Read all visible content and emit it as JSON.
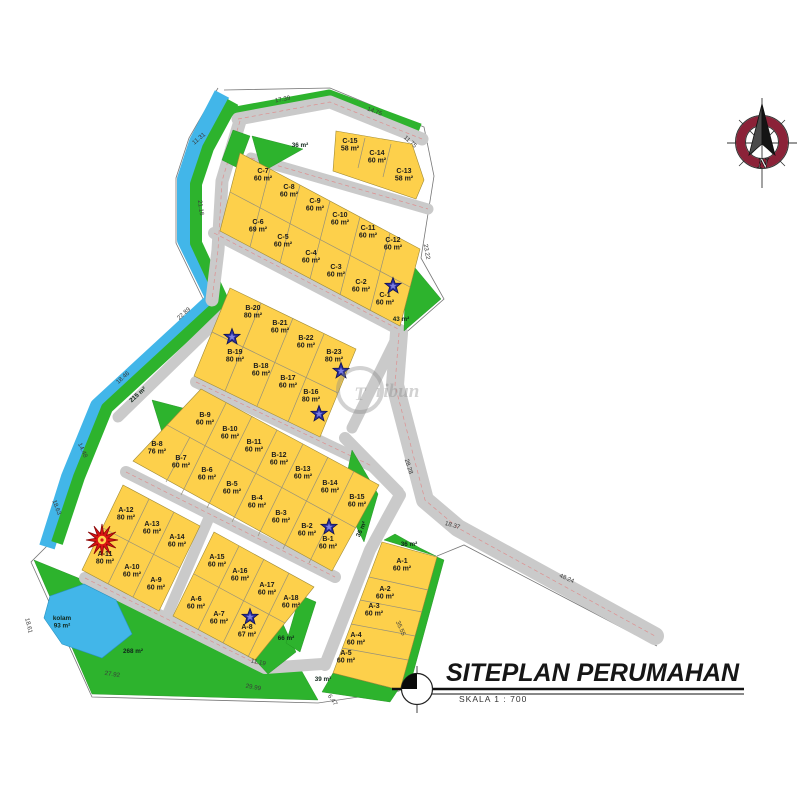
{
  "title": {
    "main": "SITEPLAN PERUMAHAN",
    "scale": "SKALA 1 : 700"
  },
  "compass": {
    "north_label": "N"
  },
  "watermark": {
    "initial": "T",
    "rest": "ribun"
  },
  "colors": {
    "lot": "#fdd04b",
    "green": "#2db32d",
    "water": "#42b6e9",
    "road": "#cacaca",
    "compass_ring": "#8b2238"
  },
  "lots": [
    {
      "id": "C-15",
      "area": "58 m²",
      "x": 350,
      "y": 143
    },
    {
      "id": "C-14",
      "area": "60 m²",
      "x": 377,
      "y": 155
    },
    {
      "id": "C-13",
      "area": "58 m²",
      "x": 404,
      "y": 173
    },
    {
      "id": "C-7",
      "area": "60 m²",
      "x": 263,
      "y": 173
    },
    {
      "id": "C-8",
      "area": "60 m²",
      "x": 289,
      "y": 189
    },
    {
      "id": "C-9",
      "area": "60 m²",
      "x": 315,
      "y": 203
    },
    {
      "id": "C-10",
      "area": "60 m²",
      "x": 340,
      "y": 217
    },
    {
      "id": "C-11",
      "area": "60 m²",
      "x": 368,
      "y": 230
    },
    {
      "id": "C-12",
      "area": "60 m²",
      "x": 393,
      "y": 242
    },
    {
      "id": "C-6",
      "area": "69 m²",
      "x": 258,
      "y": 224
    },
    {
      "id": "C-5",
      "area": "60 m²",
      "x": 283,
      "y": 239
    },
    {
      "id": "C-4",
      "area": "60 m²",
      "x": 311,
      "y": 255
    },
    {
      "id": "C-3",
      "area": "60 m²",
      "x": 336,
      "y": 269
    },
    {
      "id": "C-2",
      "area": "60 m²",
      "x": 361,
      "y": 284
    },
    {
      "id": "C-1",
      "area": "60 m²",
      "x": 385,
      "y": 297
    },
    {
      "id": "B-20",
      "area": "80 m²",
      "x": 253,
      "y": 310
    },
    {
      "id": "B-21",
      "area": "60 m²",
      "x": 280,
      "y": 325
    },
    {
      "id": "B-22",
      "area": "60 m²",
      "x": 306,
      "y": 340
    },
    {
      "id": "B-23",
      "area": "80 m²",
      "x": 334,
      "y": 354
    },
    {
      "id": "B-19",
      "area": "80 m²",
      "x": 235,
      "y": 354
    },
    {
      "id": "B-18",
      "area": "60 m²",
      "x": 261,
      "y": 368
    },
    {
      "id": "B-17",
      "area": "60 m²",
      "x": 288,
      "y": 380
    },
    {
      "id": "B-16",
      "area": "80 m²",
      "x": 311,
      "y": 394
    },
    {
      "id": "B-9",
      "area": "60 m²",
      "x": 205,
      "y": 417
    },
    {
      "id": "B-10",
      "area": "60 m²",
      "x": 230,
      "y": 431
    },
    {
      "id": "B-11",
      "area": "60 m²",
      "x": 254,
      "y": 444
    },
    {
      "id": "B-12",
      "area": "60 m²",
      "x": 279,
      "y": 457
    },
    {
      "id": "B-13",
      "area": "60 m²",
      "x": 303,
      "y": 471
    },
    {
      "id": "B-14",
      "area": "60 m²",
      "x": 330,
      "y": 485
    },
    {
      "id": "B-15",
      "area": "60 m²",
      "x": 357,
      "y": 499
    },
    {
      "id": "B-8",
      "area": "76 m²",
      "x": 157,
      "y": 446
    },
    {
      "id": "B-7",
      "area": "60 m²",
      "x": 181,
      "y": 460
    },
    {
      "id": "B-6",
      "area": "60 m²",
      "x": 207,
      "y": 472
    },
    {
      "id": "B-5",
      "area": "60 m²",
      "x": 232,
      "y": 486
    },
    {
      "id": "B-4",
      "area": "60 m²",
      "x": 257,
      "y": 500
    },
    {
      "id": "B-3",
      "area": "60 m²",
      "x": 281,
      "y": 515
    },
    {
      "id": "B-2",
      "area": "60 m²",
      "x": 307,
      "y": 528
    },
    {
      "id": "B-1",
      "area": "60 m²",
      "x": 328,
      "y": 541
    },
    {
      "id": "A-12",
      "area": "80 m²",
      "x": 126,
      "y": 512
    },
    {
      "id": "A-13",
      "area": "60 m²",
      "x": 152,
      "y": 526
    },
    {
      "id": "A-14",
      "area": "60 m²",
      "x": 177,
      "y": 539
    },
    {
      "id": "A-11",
      "area": "80 m²",
      "x": 105,
      "y": 556
    },
    {
      "id": "A-10",
      "area": "60 m²",
      "x": 132,
      "y": 569
    },
    {
      "id": "A-9",
      "area": "60 m²",
      "x": 156,
      "y": 582
    },
    {
      "id": "A-15",
      "area": "60 m²",
      "x": 217,
      "y": 559
    },
    {
      "id": "A-16",
      "area": "60 m²",
      "x": 240,
      "y": 573
    },
    {
      "id": "A-17",
      "area": "60 m²",
      "x": 267,
      "y": 587
    },
    {
      "id": "A-18",
      "area": "60 m²",
      "x": 291,
      "y": 600
    },
    {
      "id": "A-6",
      "area": "60 m²",
      "x": 196,
      "y": 601
    },
    {
      "id": "A-7",
      "area": "60 m²",
      "x": 219,
      "y": 616
    },
    {
      "id": "A-8",
      "area": "67 m²",
      "x": 247,
      "y": 629
    },
    {
      "id": "A-1",
      "area": "60 m²",
      "x": 402,
      "y": 563
    },
    {
      "id": "A-2",
      "area": "60 m²",
      "x": 385,
      "y": 591
    },
    {
      "id": "A-3",
      "area": "60 m²",
      "x": 374,
      "y": 608
    },
    {
      "id": "A-4",
      "area": "60 m²",
      "x": 356,
      "y": 637
    },
    {
      "id": "A-5",
      "area": "60 m²",
      "x": 346,
      "y": 655
    }
  ],
  "dimensions": [
    {
      "text": "17.39",
      "x": 283,
      "y": 101,
      "rot": -11
    },
    {
      "text": "14.75",
      "x": 374,
      "y": 113,
      "rot": 21
    },
    {
      "text": "11.75",
      "x": 409,
      "y": 143,
      "rot": 42
    },
    {
      "text": "23.22",
      "x": 425,
      "y": 252,
      "rot": 80
    },
    {
      "text": "11.31",
      "x": 200,
      "y": 140,
      "rot": -40
    },
    {
      "text": "21.16",
      "x": 199,
      "y": 208,
      "rot": 82
    },
    {
      "text": "22.89",
      "x": 185,
      "y": 315,
      "rot": -42
    },
    {
      "text": "18.46",
      "x": 124,
      "y": 379,
      "rot": -42
    },
    {
      "text": "14.48",
      "x": 81,
      "y": 451,
      "rot": 66
    },
    {
      "text": "18.63",
      "x": 55,
      "y": 508,
      "rot": 70
    },
    {
      "text": "18.61",
      "x": 27,
      "y": 626,
      "rot": 76
    },
    {
      "text": "27.92",
      "x": 112,
      "y": 676,
      "rot": 9
    },
    {
      "text": "29.99",
      "x": 253,
      "y": 689,
      "rot": 10
    },
    {
      "text": "6.47",
      "x": 331,
      "y": 701,
      "rot": 55
    },
    {
      "text": "35.55",
      "x": 399,
      "y": 629,
      "rot": 66
    },
    {
      "text": "28.28",
      "x": 407,
      "y": 467,
      "rot": 72
    },
    {
      "text": "18.37",
      "x": 452,
      "y": 527,
      "rot": 16
    },
    {
      "text": "48.24",
      "x": 566,
      "y": 580,
      "rot": 24
    },
    {
      "text": "11.19",
      "x": 258,
      "y": 664,
      "rot": 12
    }
  ],
  "area_labels": [
    {
      "text": "36 m²",
      "x": 300,
      "y": 147,
      "rot": 0
    },
    {
      "text": "43 m²",
      "x": 401,
      "y": 321,
      "rot": 0
    },
    {
      "text": "36 m²",
      "x": 363,
      "y": 530,
      "rot": -65
    },
    {
      "text": "36 m²",
      "x": 409,
      "y": 546,
      "rot": 0
    },
    {
      "text": "215 m²",
      "x": 139,
      "y": 396,
      "rot": -42
    },
    {
      "text": "268 m²",
      "x": 133,
      "y": 653,
      "rot": 0
    },
    {
      "text": "kolam",
      "line2": "93 m²",
      "x": 62,
      "y": 620,
      "rot": 0
    },
    {
      "text": "66 m²",
      "x": 286,
      "y": 640,
      "rot": 0
    },
    {
      "text": "39 m²",
      "x": 323,
      "y": 681,
      "rot": 0
    }
  ],
  "markers": {
    "stars": [
      {
        "x": 393,
        "y": 286
      },
      {
        "x": 232,
        "y": 337
      },
      {
        "x": 341,
        "y": 371
      },
      {
        "x": 319,
        "y": 414
      },
      {
        "x": 329,
        "y": 527
      },
      {
        "x": 250,
        "y": 617
      }
    ],
    "burst": {
      "x": 102,
      "y": 540
    }
  }
}
